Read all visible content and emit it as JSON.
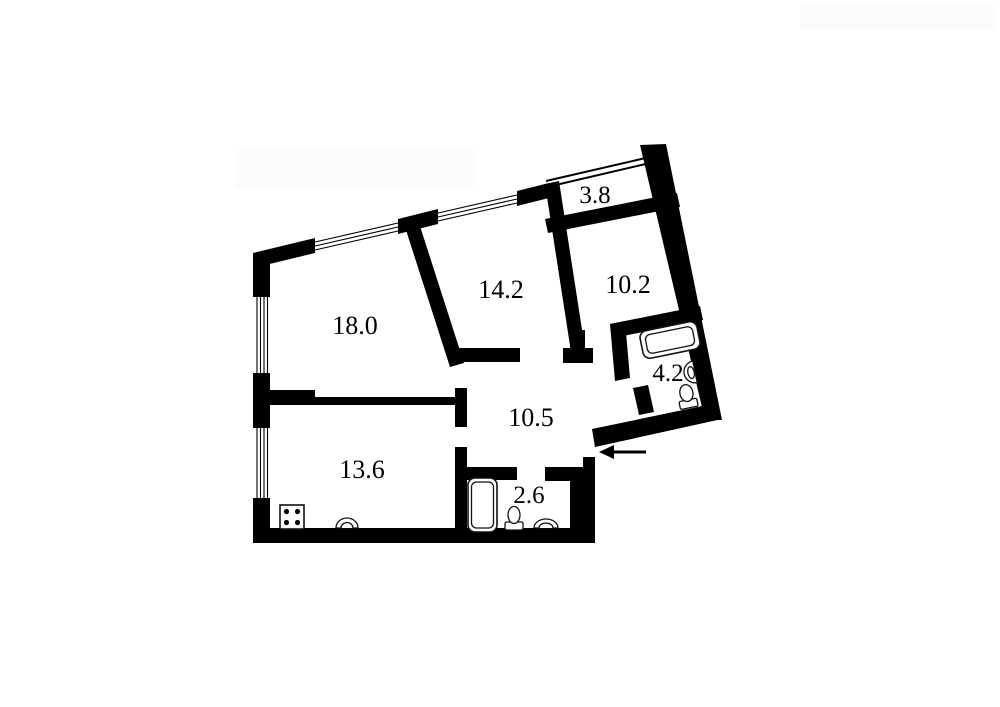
{
  "title": "Apartment floor plan",
  "colors": {
    "background": "#ffffff",
    "walls": "#000000",
    "fixture_stroke": "#111111"
  },
  "floorplan": {
    "rooms": [
      {
        "name": "living-room",
        "area_label": "18.0"
      },
      {
        "name": "bedroom-1",
        "area_label": "14.2"
      },
      {
        "name": "bedroom-2",
        "area_label": "10.2"
      },
      {
        "name": "balcony",
        "area_label": "3.8"
      },
      {
        "name": "bathroom",
        "area_label": "4.2"
      },
      {
        "name": "hallway",
        "area_label": "10.5"
      },
      {
        "name": "kitchen",
        "area_label": "13.6"
      },
      {
        "name": "wc",
        "area_label": "2.6"
      }
    ],
    "fixtures": [
      {
        "room": "4.2",
        "items": [
          "bathtub",
          "wall-sink",
          "toilet"
        ]
      },
      {
        "room": "2.6",
        "items": [
          "bathtub",
          "toilet",
          "sink"
        ]
      },
      {
        "room": "13.6",
        "items": [
          "stove",
          "sink"
        ]
      }
    ],
    "windows": {
      "count": 4,
      "style": "hatched-band"
    },
    "entrance": {
      "arrow_direction": "left"
    }
  }
}
